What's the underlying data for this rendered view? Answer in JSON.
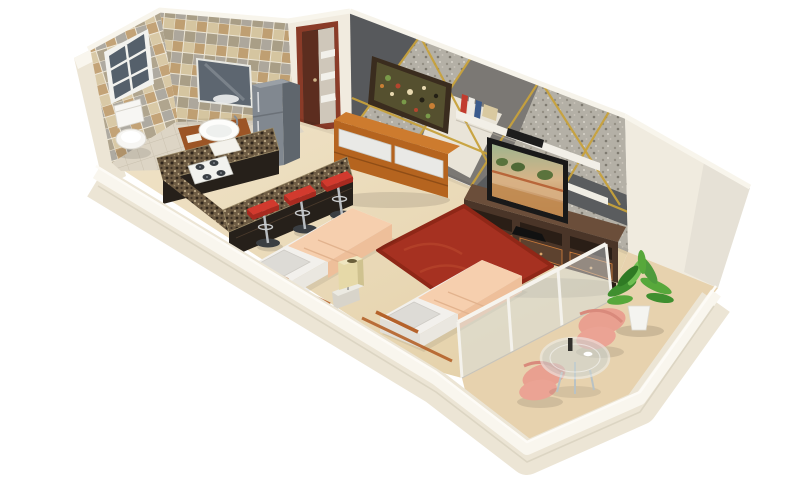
{
  "scene": {
    "description": "3D isometric cutaway floor plan render of a studio apartment with bathroom, open kitchen, combined living-sleeping area and balcony",
    "background": "#ffffff"
  },
  "palette": {
    "background": "#ffffff",
    "wall_outer": "#ece5d5",
    "wall_top": "#f9f6ee",
    "wall_inner": "#f1ebdf",
    "wall_tall": "#f0ebdf",
    "floor_main": "#eadaba",
    "floor_bath": "#ddd5c5",
    "floor_balcony": "#e7d2ae",
    "accent_base": "#7b7874",
    "accent_dark": "#57595c",
    "accent_light": "#b4b0a6",
    "accent_cream": "#e9e4d8",
    "accent_gold": "#c8a23c",
    "door_frame": "#8a3b28",
    "door_leaf": "#5c2d1f",
    "fridge": "#818890",
    "fridge_side": "#5f666d",
    "granite": "#6e5c44",
    "cabinet_dark": "#26201a",
    "stool_red": "#d23a2e",
    "wood_dresser": "#b5641f",
    "wood_dresser_top": "#cd7b2e",
    "drawer_white": "#e9e9e6",
    "console": "#4a3528",
    "console_top": "#6b4e3a",
    "tv_frame": "#191919",
    "rug": "#a63121",
    "bed_white": "#f2f0ec",
    "duvet": "#f6cfae",
    "pillow": "#dddbd6",
    "bed_rail": "#b5622a",
    "lamp": "#e6d9a8",
    "nightstand": "#d8d4ca",
    "glass": "#d8e2e6",
    "chair_salmon": "#eba394",
    "plant_green": "#4e9b3c",
    "pot_white": "#f4f4f0",
    "mirror": "#5d6670",
    "vanity_wood": "#9c5526",
    "toilet_white": "#f7f6f3",
    "art_frame": "#3a2c1e"
  },
  "rooms": [
    {
      "name": "bathroom",
      "items": [
        "plaid tiled walls",
        "window",
        "wall mirror",
        "corner shelf",
        "vessel sink on wood vanity",
        "toilet"
      ]
    },
    {
      "name": "entry",
      "items": [
        "wood entrance door",
        "open doorway with shelf nook"
      ]
    },
    {
      "name": "kitchen",
      "items": [
        "u-shaped granite counter",
        "4-burner gas hob",
        "cutting board",
        "refrigerator",
        "breakfast bar",
        "red bar stools"
      ],
      "bar_stool_count": 3
    },
    {
      "name": "living-sleeping-area",
      "items": [
        "wood dresser with white drawers",
        "abstract wall art",
        "wall sconce",
        "floating shelves",
        "books",
        "soundbar",
        "flat-screen tv",
        "tv console with drawers",
        "red shag rug",
        "single beds with peach duvets",
        "nightstand",
        "cube table lamp",
        "stone accent wall with gold inlay"
      ],
      "bed_count": 2,
      "book_count": 4
    },
    {
      "name": "balcony",
      "items": [
        "glass partition",
        "potted plant",
        "round glass table",
        "salmon lounge chairs",
        "white parapet wall"
      ],
      "lounge_chair_count": 2
    }
  ]
}
